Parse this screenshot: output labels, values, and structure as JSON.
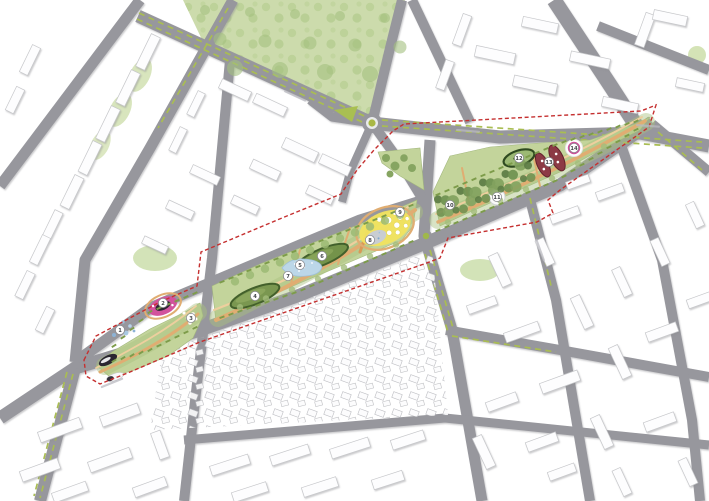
{
  "map": {
    "type": "urban-masterplan",
    "description": "aerial master plan of a linear park corridor crossing a city grid, project area outlined with red dashed boundary",
    "palette": {
      "background": "#ffffff",
      "road_gray": "#97979d",
      "building_white": "#fdfdfe",
      "building_outline": "#c6c7ca",
      "city_park_green": "#ccdbac",
      "corridor_lawn_green": "#c3d49b",
      "tree_green": "#6f9150",
      "hedge_green": "#7d9c4a",
      "median_olive": "#a9bd52",
      "roundabout_olive": "#a9b845",
      "path_tan": "#e0ad72",
      "water_blue": "#bcd7e8",
      "boundary_red": "#c53030",
      "accent_pink": "#d2539d",
      "accent_magenta": "#cf4f9a",
      "accent_maroon": "#8c3a45",
      "accent_yellow": "#f1e35f",
      "dark_feature": "#2a2630"
    },
    "boundary": {
      "style": "dashed",
      "color": "#c53030"
    },
    "markers": [
      {
        "n": "1",
        "x": 120,
        "y": 330
      },
      {
        "n": "2",
        "x": 163,
        "y": 303
      },
      {
        "n": "3",
        "x": 191,
        "y": 318
      },
      {
        "n": "4",
        "x": 255,
        "y": 296
      },
      {
        "n": "5",
        "x": 300,
        "y": 265
      },
      {
        "n": "6",
        "x": 322,
        "y": 256
      },
      {
        "n": "7",
        "x": 288,
        "y": 276
      },
      {
        "n": "8",
        "x": 370,
        "y": 240
      },
      {
        "n": "9",
        "x": 400,
        "y": 212
      },
      {
        "n": "10",
        "x": 450,
        "y": 205
      },
      {
        "n": "11",
        "x": 497,
        "y": 197
      },
      {
        "n": "12",
        "x": 519,
        "y": 158
      },
      {
        "n": "13",
        "x": 549,
        "y": 162
      },
      {
        "n": "14",
        "x": 574,
        "y": 148
      }
    ],
    "street_label_marks": [
      {
        "x": 295,
        "y": 96,
        "a": 25
      },
      {
        "x": 468,
        "y": 131,
        "a": 5
      },
      {
        "x": 648,
        "y": 126,
        "a": 4
      },
      {
        "x": 112,
        "y": 383,
        "a": -22
      },
      {
        "x": 540,
        "y": 250,
        "a": 70
      }
    ],
    "features": [
      {
        "name": "city-park",
        "color": "#ccdbac"
      },
      {
        "name": "west-tip-dark-garden",
        "color": "#2a2630"
      },
      {
        "name": "water-dot-garden",
        "color": "#7fa9cf"
      },
      {
        "name": "pink-ring-garden",
        "color": "#d2539d"
      },
      {
        "name": "lawn-mounds",
        "color": "#7a9750"
      },
      {
        "name": "pond",
        "color": "#bcd7e8"
      },
      {
        "name": "yellow-flower-garden",
        "color": "#f1e35f"
      },
      {
        "name": "tree-grove",
        "color": "#6f9150"
      },
      {
        "name": "white-plaza",
        "color": "#fafafa"
      },
      {
        "name": "dark-rim-oval-garden",
        "color": "#2f4a20"
      },
      {
        "name": "maroon-planting-beds",
        "color": "#8c3a45"
      },
      {
        "name": "magenta-circle-garden",
        "color": "#cf4f9a"
      },
      {
        "name": "project-boundary",
        "color": "#c53030"
      }
    ]
  }
}
